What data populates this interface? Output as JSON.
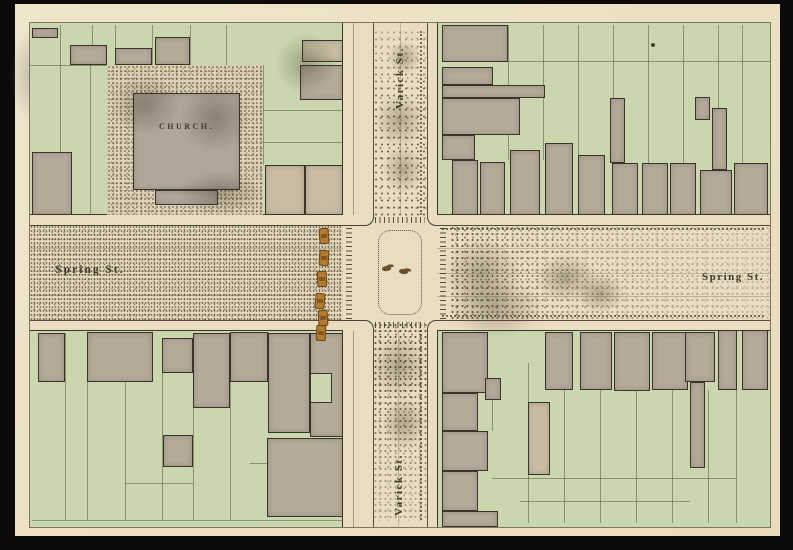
{
  "photo": {
    "frame_color": "#0c0b09",
    "paper_color": "#ece2c6"
  },
  "map": {
    "labels": {
      "church": "CHURCH.",
      "varick_top": "Varick St.",
      "varick_bottom": "Varick St.",
      "spring_west": "Spring St.",
      "spring_east": "Spring St."
    },
    "colors": {
      "street": "#e8ddc0",
      "block_green": "#c9d6ae",
      "building_gray": "#b4ab9b",
      "building_tan": "#c8bda4",
      "church_gray": "#b0a79a",
      "cart_orange": "#b57a2e",
      "ink": "#3a342a"
    },
    "blocks": {
      "nw": {
        "rect": [
          0,
          0,
          313,
          192
        ],
        "stipple": [
          [
            77,
            42,
            156,
            150
          ]
        ],
        "buildings": [
          [
            2,
            5,
            26,
            10
          ],
          [
            40,
            22,
            37,
            20
          ],
          [
            85,
            25,
            37,
            17
          ],
          [
            125,
            14,
            35,
            28
          ],
          [
            2,
            129,
            40,
            63
          ],
          [
            103,
            70,
            107,
            97,
            "church"
          ],
          [
            125,
            167,
            63,
            15,
            "church"
          ],
          [
            272,
            17,
            41,
            22,
            "tan"
          ],
          [
            270,
            42,
            43,
            35
          ],
          [
            235,
            142,
            40,
            50,
            "tan"
          ],
          [
            275,
            142,
            38,
            50,
            "tan"
          ]
        ],
        "lines": [
          [
            30,
            2,
            30,
            42
          ],
          [
            62,
            2,
            62,
            42
          ],
          [
            85,
            2,
            85,
            42
          ],
          [
            122,
            2,
            122,
            42
          ],
          [
            160,
            2,
            160,
            42
          ],
          [
            196,
            2,
            196,
            42
          ],
          [
            0,
            42,
            77,
            42
          ],
          [
            30,
            42,
            30,
            192
          ],
          [
            60,
            42,
            60,
            192
          ],
          [
            233,
            42,
            233,
            142
          ],
          [
            233,
            87,
            313,
            87
          ],
          [
            233,
            119,
            313,
            119
          ]
        ],
        "insets": []
      },
      "ne": {
        "rect": [
          407,
          0,
          333,
          192
        ],
        "stipple": [],
        "buildings": [
          [
            412,
            2,
            66,
            37
          ],
          [
            412,
            44,
            51,
            18
          ],
          [
            412,
            62,
            103,
            13
          ],
          [
            412,
            75,
            78,
            37
          ],
          [
            412,
            112,
            33,
            25
          ],
          [
            580,
            75,
            15,
            65
          ],
          [
            665,
            74,
            15,
            23
          ],
          [
            682,
            85,
            15,
            62
          ],
          [
            422,
            137,
            26,
            55
          ],
          [
            450,
            139,
            25,
            53
          ],
          [
            480,
            127,
            30,
            65
          ],
          [
            515,
            120,
            28,
            72
          ],
          [
            548,
            132,
            27,
            60
          ],
          [
            582,
            140,
            26,
            52
          ],
          [
            612,
            140,
            26,
            52
          ],
          [
            640,
            140,
            26,
            52
          ],
          [
            670,
            147,
            32,
            45
          ],
          [
            704,
            140,
            34,
            52
          ]
        ],
        "lines": [
          [
            478,
            2,
            478,
            137
          ],
          [
            513,
            2,
            513,
            137
          ],
          [
            548,
            2,
            548,
            132
          ],
          [
            583,
            2,
            583,
            140
          ],
          [
            618,
            2,
            618,
            140
          ],
          [
            653,
            2,
            653,
            140
          ],
          [
            688,
            2,
            688,
            147
          ],
          [
            712,
            2,
            712,
            140
          ],
          [
            445,
            38,
            740,
            38
          ]
        ],
        "insets": []
      },
      "sw": {
        "rect": [
          0,
          307,
          313,
          197
        ],
        "stipple": [],
        "buildings": [
          [
            8,
            310,
            27,
            49
          ],
          [
            57,
            309,
            66,
            50
          ],
          [
            132,
            315,
            31,
            35
          ],
          [
            163,
            310,
            37,
            75
          ],
          [
            200,
            309,
            38,
            50
          ],
          [
            238,
            310,
            42,
            100
          ],
          [
            280,
            310,
            33,
            104
          ],
          [
            133,
            412,
            30,
            32
          ],
          [
            237,
            415,
            76,
            79
          ]
        ],
        "lines": [
          [
            35,
            310,
            35,
            497
          ],
          [
            57,
            359,
            57,
            497
          ],
          [
            95,
            310,
            95,
            497
          ],
          [
            132,
            350,
            132,
            497
          ],
          [
            163,
            385,
            163,
            497
          ],
          [
            200,
            359,
            200,
            497
          ],
          [
            2,
            497,
            313,
            497
          ],
          [
            95,
            460,
            163,
            460
          ],
          [
            220,
            440,
            237,
            440
          ]
        ],
        "insets": [
          [
            280,
            350,
            22,
            30
          ]
        ]
      },
      "se": {
        "rect": [
          407,
          307,
          333,
          197
        ],
        "stipple": [],
        "buildings": [
          [
            412,
            309,
            46,
            61
          ],
          [
            412,
            370,
            36,
            38
          ],
          [
            412,
            408,
            46,
            40
          ],
          [
            412,
            448,
            36,
            40
          ],
          [
            412,
            488,
            56,
            16
          ],
          [
            455,
            355,
            16,
            22
          ],
          [
            498,
            379,
            22,
            73,
            "tan"
          ],
          [
            515,
            309,
            28,
            58
          ],
          [
            550,
            309,
            32,
            58
          ],
          [
            584,
            309,
            36,
            59
          ],
          [
            622,
            309,
            36,
            58
          ],
          [
            655,
            309,
            30,
            50
          ],
          [
            660,
            359,
            15,
            86
          ],
          [
            688,
            307,
            19,
            60
          ],
          [
            712,
            307,
            26,
            60
          ]
        ],
        "lines": [
          [
            498,
            340,
            498,
            500
          ],
          [
            534,
            340,
            534,
            500
          ],
          [
            570,
            367,
            570,
            500
          ],
          [
            606,
            340,
            606,
            500
          ],
          [
            642,
            367,
            642,
            500
          ],
          [
            678,
            367,
            678,
            500
          ],
          [
            706,
            367,
            706,
            500
          ],
          [
            462,
            455,
            706,
            455
          ],
          [
            490,
            478,
            660,
            478
          ],
          [
            462,
            370,
            462,
            408
          ]
        ],
        "insets": []
      }
    },
    "street_patches": [
      [
        345,
        70,
        50,
        55
      ],
      [
        352,
        122,
        42,
        48
      ],
      [
        358,
        18,
        32,
        34
      ],
      [
        340,
        312,
        58,
        62
      ],
      [
        352,
        374,
        44,
        52
      ],
      [
        412,
        215,
        80,
        72
      ],
      [
        418,
        255,
        95,
        60
      ],
      [
        505,
        232,
        62,
        46
      ],
      [
        80,
        52,
        70,
        60
      ],
      [
        148,
        148,
        84,
        44
      ],
      [
        150,
        60,
        70,
        70
      ],
      [
        245,
        10,
        62,
        62
      ],
      [
        545,
        250,
        50,
        40
      ]
    ],
    "carts": [
      [
        289,
        205,
        -5
      ],
      [
        289,
        227,
        4
      ],
      [
        287,
        248,
        -3
      ],
      [
        285,
        270,
        6
      ],
      [
        288,
        287,
        -4
      ],
      [
        286,
        302,
        3
      ]
    ],
    "horses": [
      [
        352,
        243,
        -8
      ],
      [
        369,
        246,
        6
      ]
    ],
    "ink_spots": [
      [
        621,
        20
      ]
    ]
  }
}
